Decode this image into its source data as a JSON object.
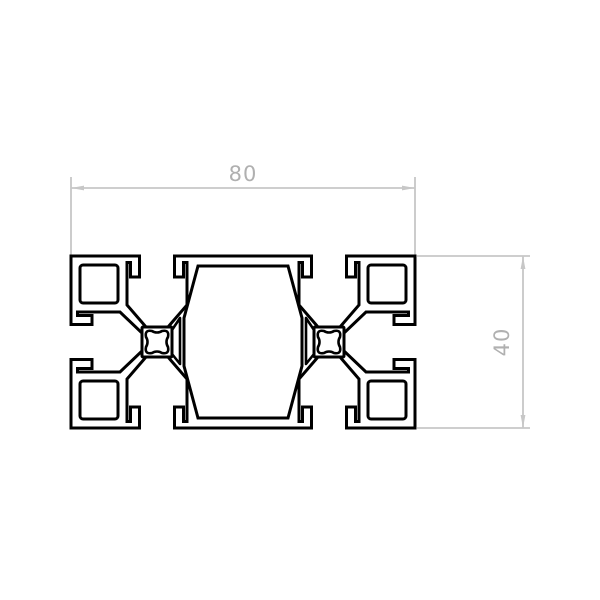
{
  "drawing": {
    "kind": "extrusion-profile-cross-section",
    "dimensions": {
      "width": {
        "value": "80"
      },
      "height": {
        "value": "40"
      }
    }
  },
  "colors": {
    "background": "#ffffff",
    "profile-line": "#000000",
    "dim-line": "#c7c7c7",
    "dim-text": "#b0b0b0"
  }
}
